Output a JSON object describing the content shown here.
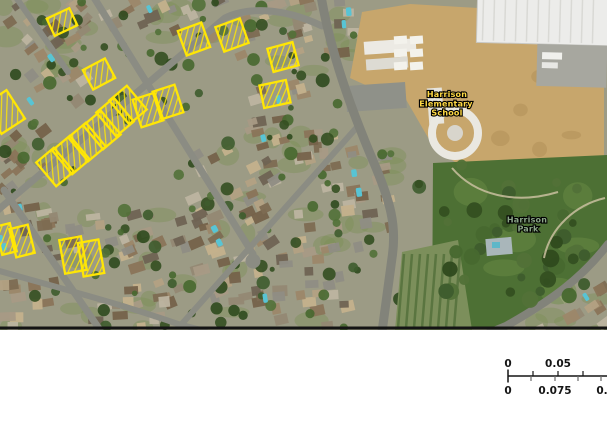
{
  "map_labels": {
    "school": {
      "lines": [
        "Harrison",
        "Elementary",
        "School"
      ],
      "color": "#ffd944"
    },
    "park": {
      "lines": [
        "Harrison",
        "Park"
      ],
      "color": "#8ba689"
    }
  },
  "annotations": {
    "color": "#ffe605",
    "type": "oriented-bounding-boxes-with-hatch",
    "boxes": [
      {
        "cx": 62,
        "cy": 22,
        "w": 25,
        "h": 19,
        "rot": -25
      },
      {
        "cx": 99,
        "cy": 74,
        "w": 25,
        "h": 22,
        "rot": -28
      },
      {
        "cx": 4,
        "cy": 112,
        "w": 28,
        "h": 34,
        "rot": -33
      },
      {
        "cx": 55,
        "cy": 167,
        "w": 23,
        "h": 31,
        "rot": -40
      },
      {
        "cx": 71,
        "cy": 155,
        "w": 23,
        "h": 31,
        "rot": -40
      },
      {
        "cx": 87,
        "cy": 142,
        "w": 23,
        "h": 31,
        "rot": -40
      },
      {
        "cx": 102,
        "cy": 130,
        "w": 23,
        "h": 31,
        "rot": -40
      },
      {
        "cx": 115,
        "cy": 117,
        "w": 23,
        "h": 31,
        "rot": -40
      },
      {
        "cx": 128,
        "cy": 105,
        "w": 23,
        "h": 31,
        "rot": -40
      },
      {
        "cx": 148,
        "cy": 110,
        "w": 23,
        "h": 29,
        "rot": -18
      },
      {
        "cx": 168,
        "cy": 102,
        "w": 23,
        "h": 29,
        "rot": -18
      },
      {
        "cx": 194,
        "cy": 39,
        "w": 25,
        "h": 26,
        "rot": -20
      },
      {
        "cx": 232,
        "cy": 35,
        "w": 26,
        "h": 26,
        "rot": -20
      },
      {
        "cx": 283,
        "cy": 57,
        "w": 26,
        "h": 24,
        "rot": -15
      },
      {
        "cx": 275,
        "cy": 94,
        "w": 27,
        "h": 23,
        "rot": -12
      },
      {
        "cx": 6,
        "cy": 239,
        "w": 15,
        "h": 29,
        "rot": -14
      },
      {
        "cx": 22,
        "cy": 241,
        "w": 19,
        "h": 29,
        "rot": -14
      },
      {
        "cx": 73,
        "cy": 255,
        "w": 22,
        "h": 34,
        "rot": -10
      },
      {
        "cx": 91,
        "cy": 258,
        "w": 21,
        "h": 34,
        "rot": -10
      }
    ]
  },
  "scalebar": {
    "top_labels": [
      "0",
      "0.05"
    ],
    "bottom_labels": [
      "0",
      "0.075",
      "0."
    ],
    "line_color": "#151515",
    "minor_tick_color": "#6a6a6a"
  }
}
